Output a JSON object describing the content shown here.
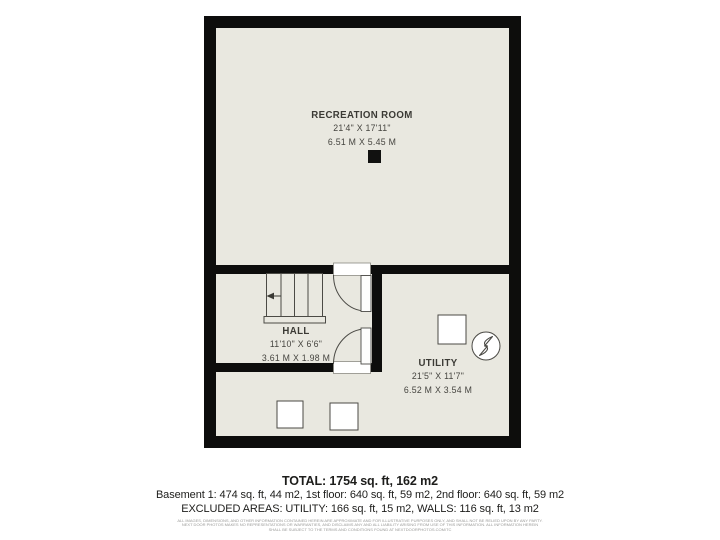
{
  "palette": {
    "background": "#ffffff",
    "floor": "#e9e8e0",
    "wall": "#0d0d0c",
    "fixture_outline": "#4b4a45",
    "plan_text": "#3b3a35",
    "footer_text": "#1d1d1b",
    "disclaimer_text": "#9a9a98"
  },
  "floorplan": {
    "rooms": [
      {
        "name": "RECREATION ROOM",
        "imperial": "21'4\" X 17'11\"",
        "metric": "6.51 M X 5.45 M"
      },
      {
        "name": "HALL",
        "imperial": "11'10\" X 6'6\"",
        "metric": "3.61 M X 1.98 M"
      },
      {
        "name": "UTILITY",
        "imperial": "21'5\" X 11'7\"",
        "metric": "6.52 M X 3.54 M"
      }
    ],
    "icons": [
      "furnace-fan-icon",
      "stairs-direction-arrow-icon",
      "door-swing-arc",
      "support-post"
    ]
  },
  "footer": {
    "total": "TOTAL: 1754 sq. ft, 162 m2",
    "floors": "Basement 1: 474 sq. ft, 44 m2, 1st floor: 640 sq. ft, 59 m2, 2nd floor: 640 sq. ft, 59 m2",
    "excluded": "EXCLUDED AREAS: UTILITY: 166 sq. ft, 15 m2, WALLS: 116 sq. ft, 13 m2",
    "disclaimer": [
      "ALL IMAGES, DIMENSIONS, AND OTHER INFORMATION CONTAINED HEREIN ARE APPROXIMATE AND FOR ILLUSTRATIVE PURPOSES ONLY, AND SHALL NOT BE RELIED UPON BY ANY PARTY.",
      "NEXT DOOR PHOTOS MAKES NO REPRESENTATIONS OR WARRANTIES, AND DISCLAIMS ANY AND ALL LIABILITY ARISING FROM USE OF THIS INFORMATION. ALL INFORMATION HEREIN",
      "SHALL BE SUBJECT TO THE TERMS AND CONDITIONS FOUND AT NEXTDOORPHOTOS.COM/TC"
    ]
  }
}
